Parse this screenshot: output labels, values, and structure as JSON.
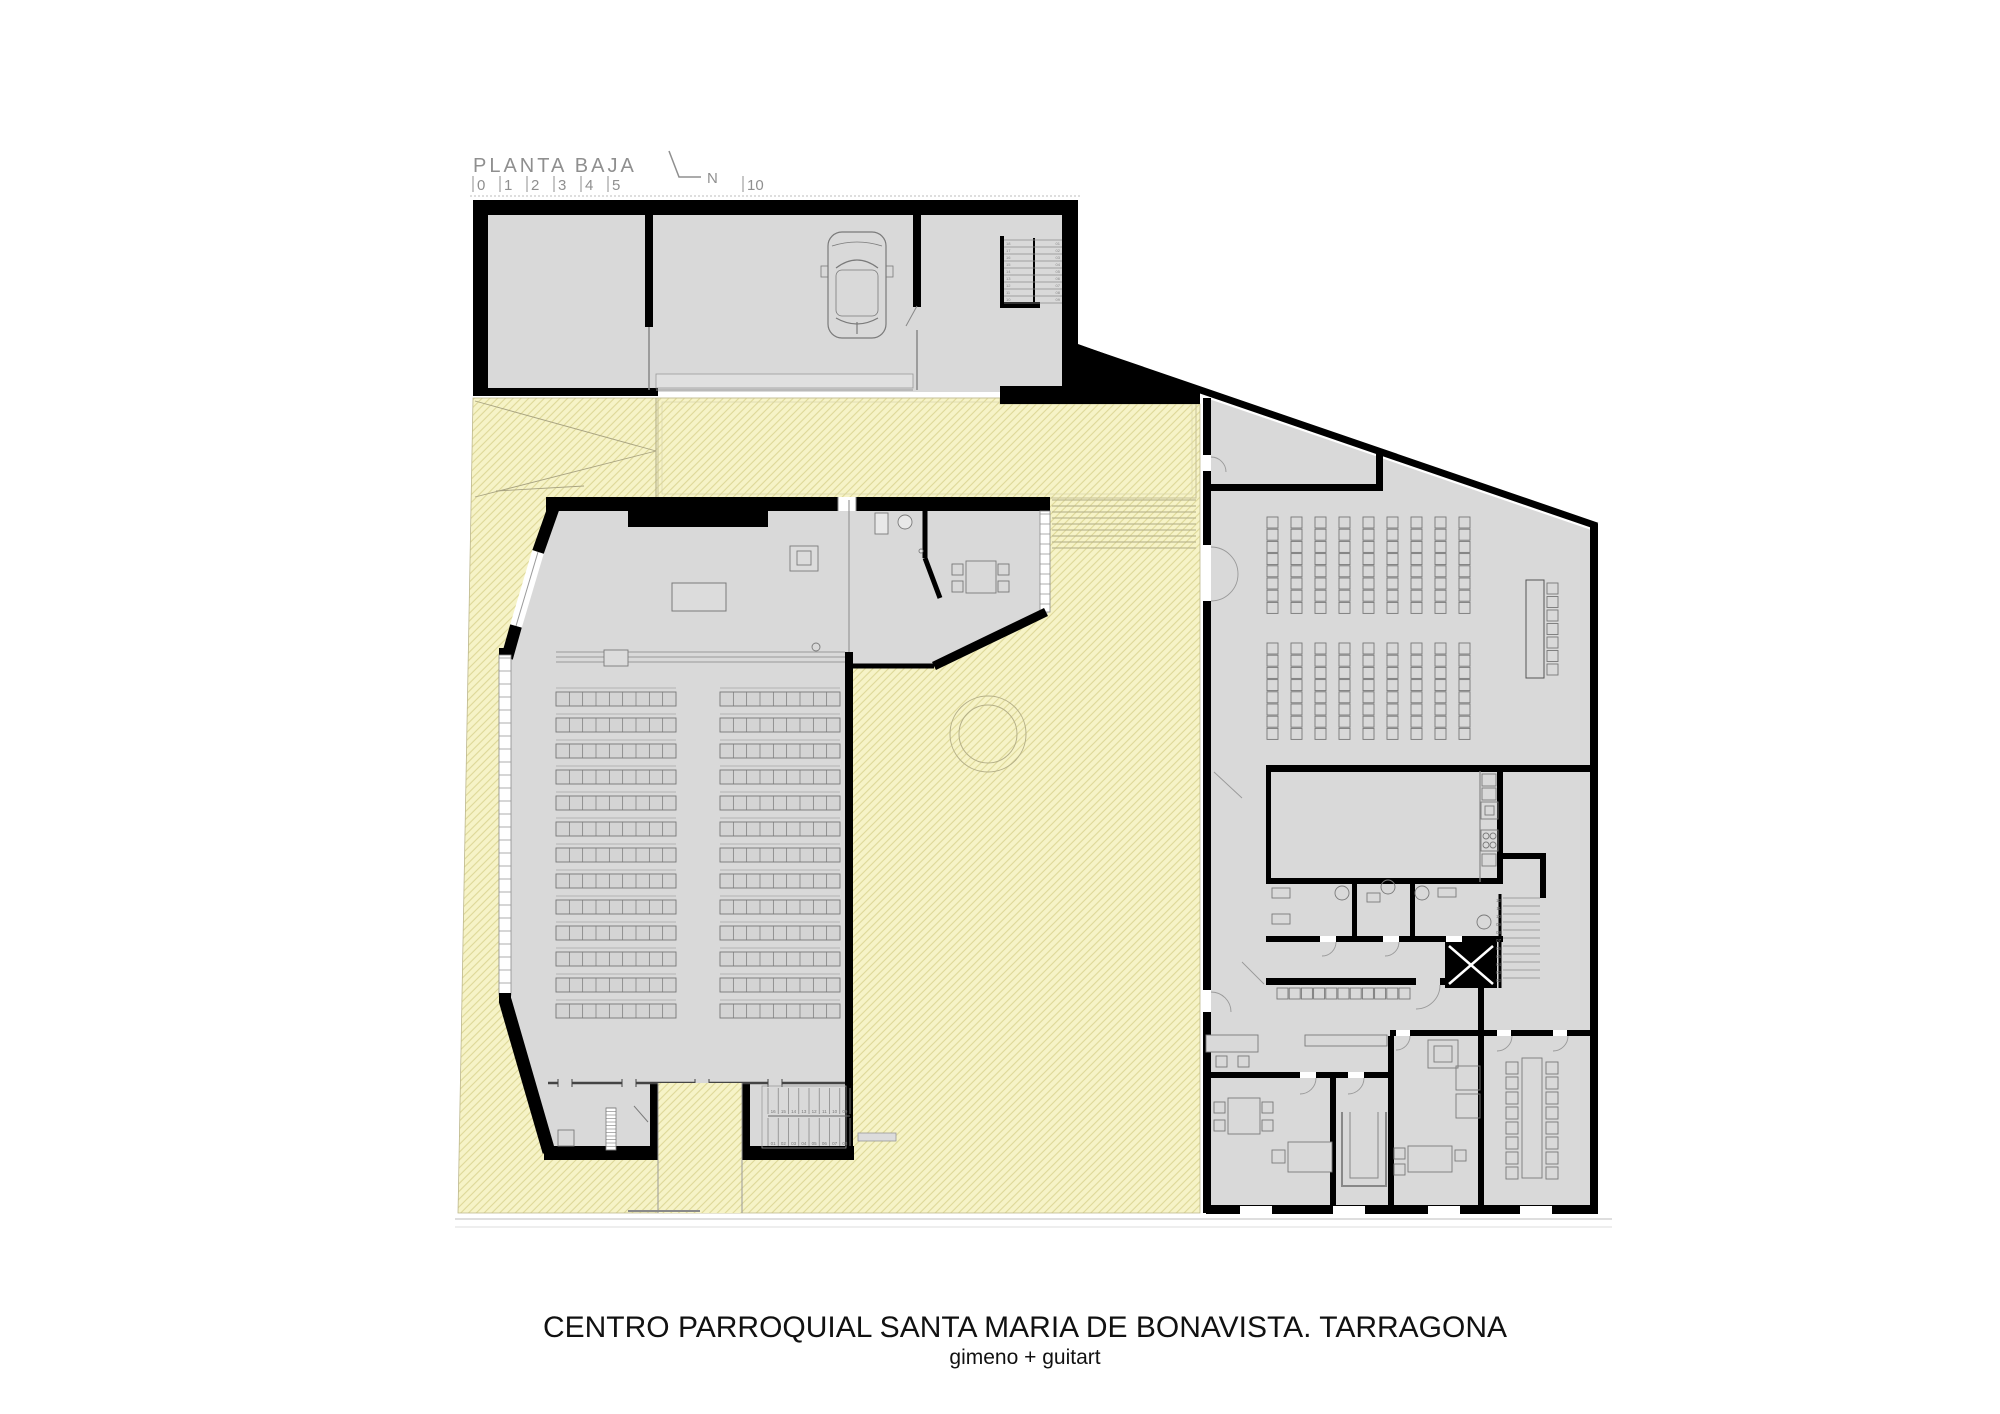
{
  "colors": {
    "courtyard_fill": "#f6f3c7",
    "hatch_line": "#ded898",
    "floor": "#d9d9d9",
    "wall": "#000000",
    "drawing_line": "#7a7a7a",
    "annotation_text": "#8f8f8f",
    "title_text": "#111111"
  },
  "header": {
    "plan_label": "PLANTA BAJA",
    "scale_ticks": [
      "0",
      "1",
      "2",
      "3",
      "4",
      "5"
    ],
    "scale_tick_far": "10",
    "north_label": "N"
  },
  "title": {
    "line1": "CENTRO PARROQUIAL SANTA MARIA DE BONAVISTA. TARRAGONA",
    "line2": "gimeno + guitart"
  },
  "stairs": {
    "church_upper": [
      "16",
      "15",
      "14",
      "13",
      "12",
      "11",
      "10",
      "09"
    ],
    "church_lower": [
      "01",
      "02",
      "03",
      "04",
      "05",
      "06",
      "07",
      "08"
    ],
    "right_building": [
      "12",
      "11",
      "10",
      "09",
      "08",
      "07",
      "06",
      "05",
      "04",
      "03",
      "02"
    ],
    "garage_left": [
      "18",
      "17",
      "16",
      "15",
      "14",
      "13",
      "12",
      "11",
      "10"
    ],
    "garage_right": [
      "01",
      "02",
      "03",
      "04",
      "05",
      "06",
      "07",
      "08",
      "09"
    ]
  },
  "furniture": {
    "pews": {
      "cols": [
        556,
        720
      ],
      "width": 120,
      "rows": 13,
      "y0": 692,
      "pitch": 26,
      "seat_h": 14,
      "dividers": 8
    },
    "assembly_chairs": {
      "x0": 1267,
      "cols": 9,
      "col_pitch": 24,
      "size": 11,
      "row_pitch": 12.2,
      "blocks": [
        {
          "y0": 517,
          "rows": 8
        },
        {
          "y0": 643,
          "rows": 8
        }
      ]
    },
    "head_chairs": {
      "x": 1547,
      "y0": 583,
      "pitch": 13.5,
      "n": 7,
      "size": 11
    },
    "hall_chairs": {
      "x0": 1277,
      "y": 988,
      "pitch": 12.2,
      "n": 11,
      "size": 11
    },
    "meeting_chairs": {
      "cols": [
        1506,
        1546
      ],
      "y0": 1062,
      "pitch": 15,
      "n": 8,
      "size": 12
    },
    "sacristy_chairs": {
      "positions": [
        [
          952,
          564
        ],
        [
          952,
          581
        ],
        [
          998,
          564
        ],
        [
          998,
          581
        ]
      ],
      "size": 11
    },
    "office_chairs": {
      "positions": [
        [
          1214,
          1102
        ],
        [
          1214,
          1120
        ],
        [
          1262,
          1102
        ],
        [
          1262,
          1120
        ],
        [
          1216,
          1056
        ],
        [
          1238,
          1056
        ],
        [
          1394,
          1148
        ],
        [
          1394,
          1164
        ]
      ],
      "size": 11
    },
    "church_stair": {
      "x0": 768,
      "x1": 850,
      "treads": 8,
      "flights": [
        {
          "y0": 1088,
          "h": 26
        },
        {
          "y0": 1118,
          "h": 28
        }
      ]
    },
    "right_stair": {
      "x0": 1503,
      "x1": 1540,
      "y0": 898,
      "pitch": 8,
      "n": 11
    },
    "garage_stair": {
      "y0": 240,
      "pitch": 7,
      "n": 10,
      "flights": [
        {
          "x0": 1004,
          "x1": 1034
        },
        {
          "x0": 1034,
          "x1": 1062
        }
      ]
    },
    "courtyard_steps": {
      "x0": 1052,
      "x1": 1196,
      "y0": 500,
      "pitch": 6,
      "n": 9
    },
    "window_mullions": [
      {
        "x": 499,
        "w": 12,
        "y0": 658,
        "y1": 993,
        "pitch": 13
      },
      {
        "x": 1040,
        "w": 10,
        "y0": 514,
        "y1": 610,
        "pitch": 10
      }
    ],
    "ladder": {
      "x": 606,
      "y": 1108,
      "w": 10,
      "h": 42,
      "pitch": 3.5
    }
  }
}
